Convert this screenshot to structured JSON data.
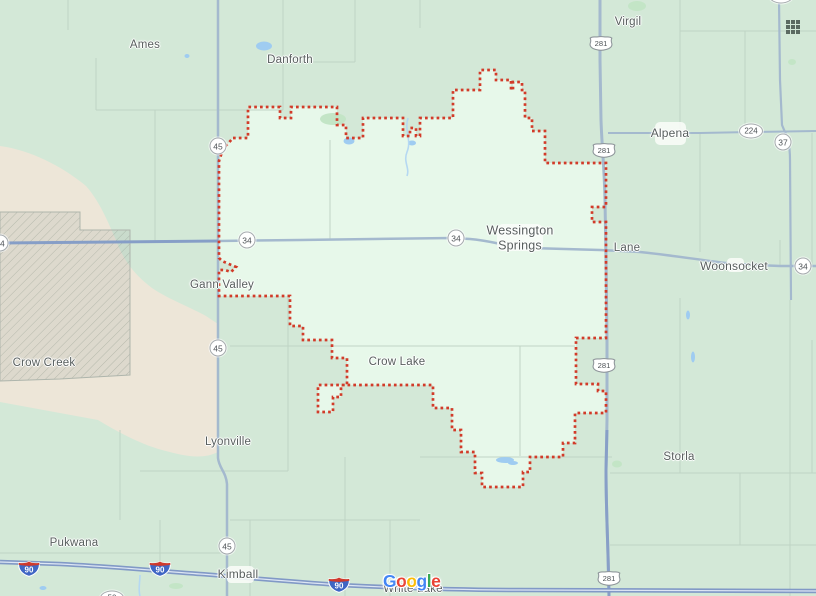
{
  "map": {
    "region_name": "county boundary highlight",
    "colors": {
      "bg": "#d3e8d7",
      "county": "#e7f8ea",
      "beige": "#ede6d8",
      "boundary": "#d23b29",
      "water": "#9fccf1",
      "stream": "#b5d8f2",
      "road": "#a4b9ce",
      "roadBlue": "#8199c6",
      "roadCenter": "#dde6f4",
      "roadMinor": "#bdd2c2",
      "label": "#575e5d",
      "townPatch": "#f9fcf8",
      "shieldBorder": "#a6abae",
      "shieldText": "#4e5357",
      "interstateBlue": "#3f66c4",
      "interstateRed": "#cf3a2d",
      "gridIcon": "#5b6a61"
    },
    "labels": [
      {
        "text": "Ames",
        "x": 145,
        "y": 46,
        "s": 11.5
      },
      {
        "text": "Danforth",
        "x": 290,
        "y": 61,
        "s": 11.5
      },
      {
        "text": "Virgil",
        "x": 628,
        "y": 23,
        "s": 11.5
      },
      {
        "text": "Alpena",
        "x": 670,
        "y": 133,
        "s": 12
      },
      {
        "text": "Wessington Springs",
        "lines": [
          "Wessington",
          "Springs"
        ],
        "x": 520,
        "y": 238,
        "s": 12.5
      },
      {
        "text": "Lane",
        "x": 627,
        "y": 249,
        "s": 11.5
      },
      {
        "text": "Woonsocket",
        "x": 734,
        "y": 266,
        "s": 12
      },
      {
        "text": "Gann Valley",
        "x": 222,
        "y": 286,
        "s": 11.5
      },
      {
        "text": "Crow Creek",
        "x": 44,
        "y": 364,
        "s": 11.5
      },
      {
        "text": "Crow Lake",
        "x": 397,
        "y": 363,
        "s": 11.5
      },
      {
        "text": "Lyonville",
        "x": 228,
        "y": 443,
        "s": 11.5
      },
      {
        "text": "Storla",
        "x": 679,
        "y": 458,
        "s": 11.5
      },
      {
        "text": "Pukwana",
        "x": 74,
        "y": 544,
        "s": 11.5
      },
      {
        "text": "Kimball",
        "x": 238,
        "y": 574,
        "s": 12
      },
      {
        "text": "White Lake",
        "x": 413,
        "y": 590,
        "s": 11.5
      }
    ],
    "shields": [
      {
        "t": "circle",
        "n": "45",
        "x": 218,
        "y": 146
      },
      {
        "t": "circle",
        "n": "45",
        "x": 218,
        "y": 348
      },
      {
        "t": "circle",
        "n": "45",
        "x": 227,
        "y": 546
      },
      {
        "t": "circle",
        "n": "34",
        "x": 0,
        "y": 243
      },
      {
        "t": "circle",
        "n": "34",
        "x": 247,
        "y": 240
      },
      {
        "t": "circle",
        "n": "34",
        "x": 456,
        "y": 238
      },
      {
        "t": "circle",
        "n": "34",
        "x": 803,
        "y": 266
      },
      {
        "t": "circle",
        "n": "37",
        "x": 783,
        "y": 142
      },
      {
        "t": "oval",
        "n": "224",
        "x": 751,
        "y": 131
      },
      {
        "t": "oval",
        "n": "37",
        "x": 781,
        "y": -4
      },
      {
        "t": "oval",
        "n": "50",
        "x": 112,
        "y": 598
      },
      {
        "t": "us",
        "n": "281",
        "x": 601,
        "y": 43
      },
      {
        "t": "us",
        "n": "281",
        "x": 604,
        "y": 150
      },
      {
        "t": "us",
        "n": "281",
        "x": 604,
        "y": 365
      },
      {
        "t": "us",
        "n": "281",
        "x": 609,
        "y": 578
      },
      {
        "t": "interstate",
        "n": "90",
        "x": 29,
        "y": 569
      },
      {
        "t": "interstate",
        "n": "90",
        "x": 160,
        "y": 569
      },
      {
        "t": "interstate",
        "n": "90",
        "x": 339,
        "y": 585
      }
    ],
    "logo": {
      "text": "Google",
      "colors": [
        "#4285F4",
        "#EA4335",
        "#FBBC05",
        "#4285F4",
        "#34A853",
        "#EA4335"
      ]
    },
    "apps_grid_cells": 9
  }
}
